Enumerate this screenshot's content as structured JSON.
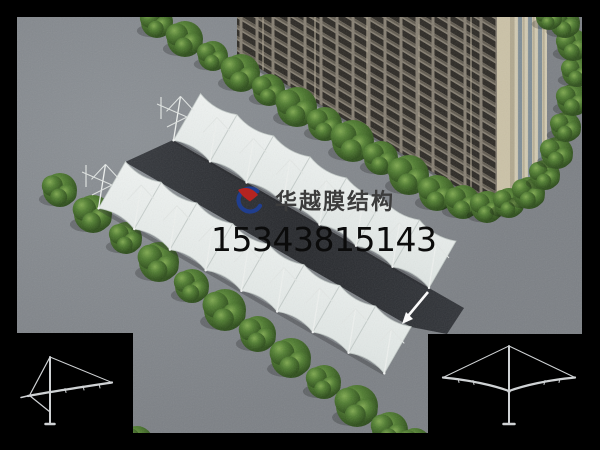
{
  "watermark": {
    "company_name": "华越膜结构",
    "phone_number": "15343815143"
  },
  "colors": {
    "logo_blue": "#1f3f96",
    "logo_red": "#c0231f",
    "company_text": "#3c3c3c",
    "phone_text": "#0b0b0b",
    "membrane_white": "#eef2f1",
    "asphalt_gray": "#7c8085",
    "foliage_green": "#4c7a2f",
    "shadow_gap": "#2a2c30",
    "background_black": "#000000",
    "diagram_line": "#cfd2d4"
  }
}
